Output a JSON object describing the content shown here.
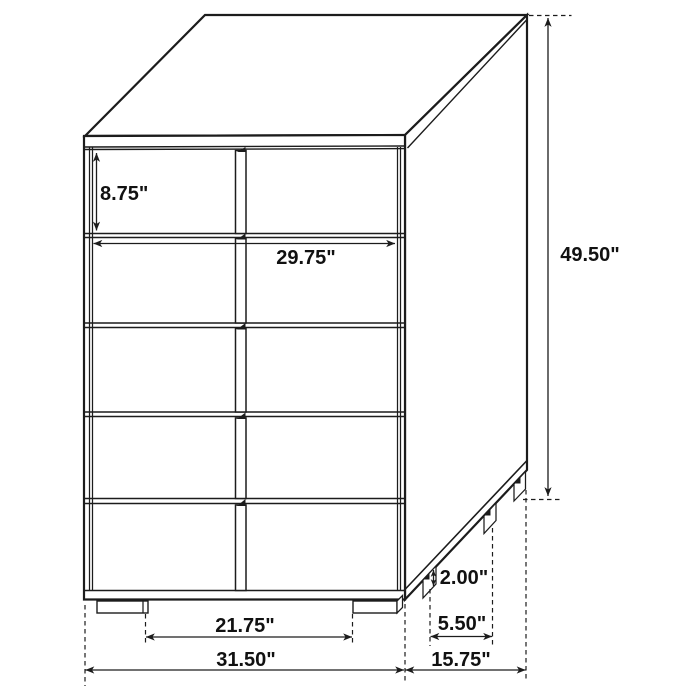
{
  "figure": {
    "subject": "5-drawer chest dimension diagram",
    "drawer_count": 5,
    "units": "inches",
    "background_color": "#ffffff",
    "line_color": "#1c1c1c",
    "text_color": "#111111"
  },
  "dimensions": {
    "drawer_face_height": {
      "label": "8.75\"",
      "value": 8.75
    },
    "drawer_width": {
      "label": "29.75\"",
      "value": 29.75
    },
    "overall_height": {
      "label": "49.50\"",
      "value": 49.5
    },
    "foot_height": {
      "label": "2.00\"",
      "value": 2.0
    },
    "side_foot_spacing": {
      "label": "5.50\"",
      "value": 5.5
    },
    "overall_depth": {
      "label": "15.75\"",
      "value": 15.75
    },
    "front_feet_spacing": {
      "label": "21.75\"",
      "value": 21.75
    },
    "overall_width": {
      "label": "31.50\"",
      "value": 31.5
    }
  }
}
